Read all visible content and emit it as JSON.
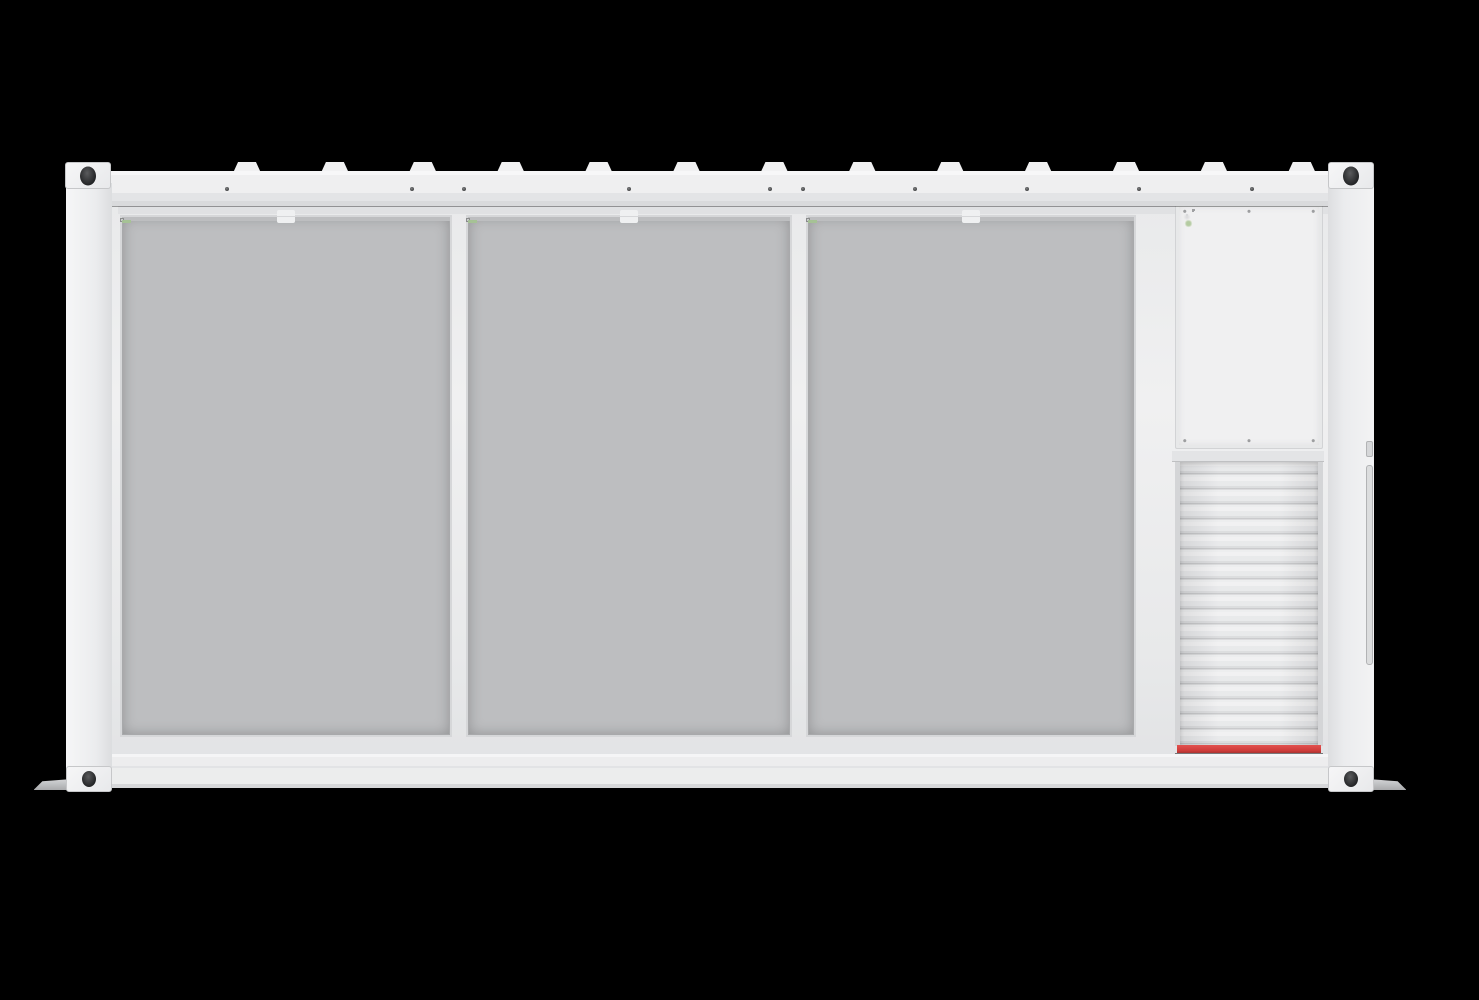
{
  "scene": {
    "title": "Containerized battery energy storage system (BESS) — front elevation render",
    "description": "White ISO-style container with open front showing three battery bays of stacked battery modules, a power-conversion cabinet with three converter drawer units, and a louvered roll-up vent panel with a red safety stripe at its base, on a black background.",
    "left_section": "3 battery bays, each 3 columns x 7 rows of battery modules with perforated vent grilles",
    "right_section": "converter cabinet (3 units, each with 4 green status LEDs and a ventilation mesh) above a louvered shutter panel with red stripe"
  },
  "layout_counts": {
    "battery_bays": 3,
    "module_columns_per_bay": 3,
    "module_rows_per_bay": 7,
    "battery_modules_per_bay": 21,
    "battery_modules_total": 63,
    "converter_units": 3,
    "status_leds_per_converter_unit": 4,
    "shutter_slats": 19,
    "roof_lifting_lugs": 13,
    "rail_bolt_dots": 10,
    "corner_castings": 4,
    "mounting_feet": 2
  },
  "colors": {
    "background": "#000000",
    "container_white": "#eceded",
    "rail_light": "#f1f1f2",
    "panel_face": "#e8e9eb",
    "vent_gray": "#b2b3b5",
    "rack_gray": "#c6c7c9",
    "recess_dark": "#151617",
    "mesh_gray": "#c5c6c8",
    "led_green": "#b4cba1",
    "module_label_green": "#a6c295",
    "accent_red": "#cf3c3a",
    "hole_dark": "#2b2c2e"
  }
}
